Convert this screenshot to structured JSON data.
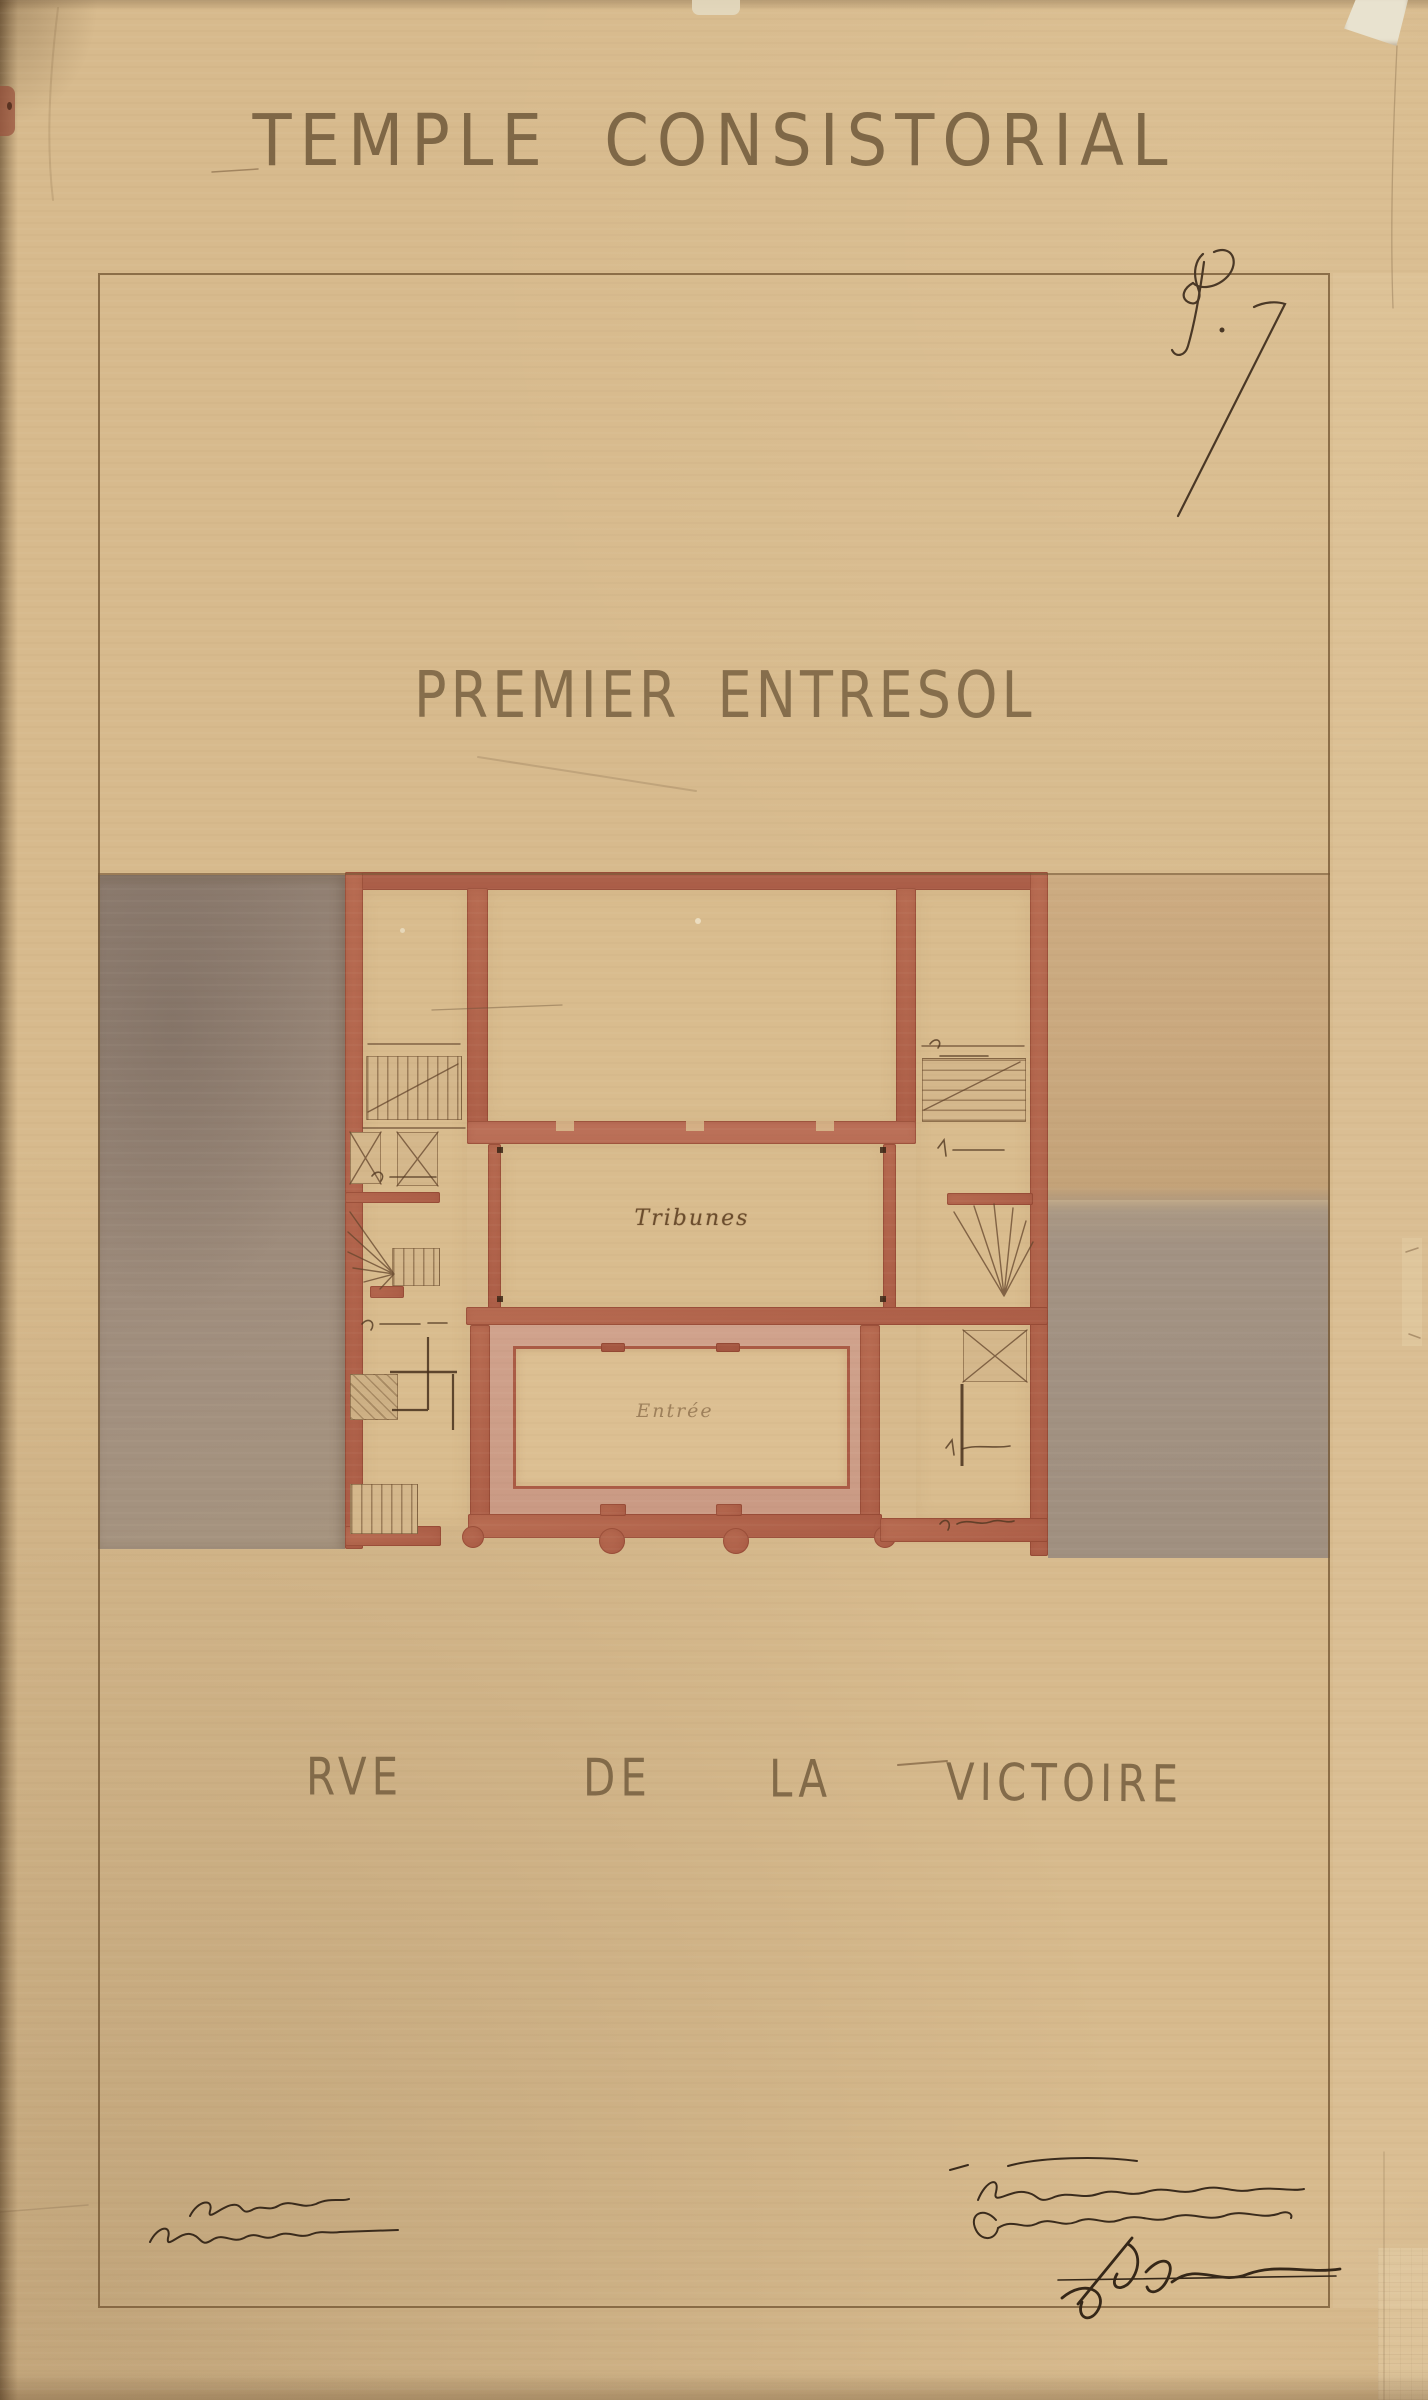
{
  "sheet": {
    "title": "TEMPLE CONSISTORIAL",
    "figure_mark": "f. 7",
    "floor_label": "PREMIER ENTRESOL",
    "street": {
      "words": [
        "RVE",
        "DE",
        "LA",
        "VICTOIRE"
      ]
    },
    "plan": {
      "room_labels": {
        "tribunes": "Tribunes",
        "entree": "Entrée"
      }
    },
    "signatures": {
      "architect_left": {
        "legible": false,
        "lines": 2
      },
      "approval_right": {
        "legible": false,
        "lines": 2
      },
      "bottom_right": {
        "legible": false,
        "lines": 1
      }
    },
    "palette": {
      "paper": "#d5b786",
      "wall_red": "#b4684f",
      "wash_pink": "#cf9f89",
      "wash_gray_left": "#9c8a7c",
      "wash_gray_right": "#a39484",
      "neighbor_tan": "#cbaa80",
      "ink": "#6e4f35",
      "lettering": "#786141",
      "frame_line": "#76582f"
    }
  }
}
